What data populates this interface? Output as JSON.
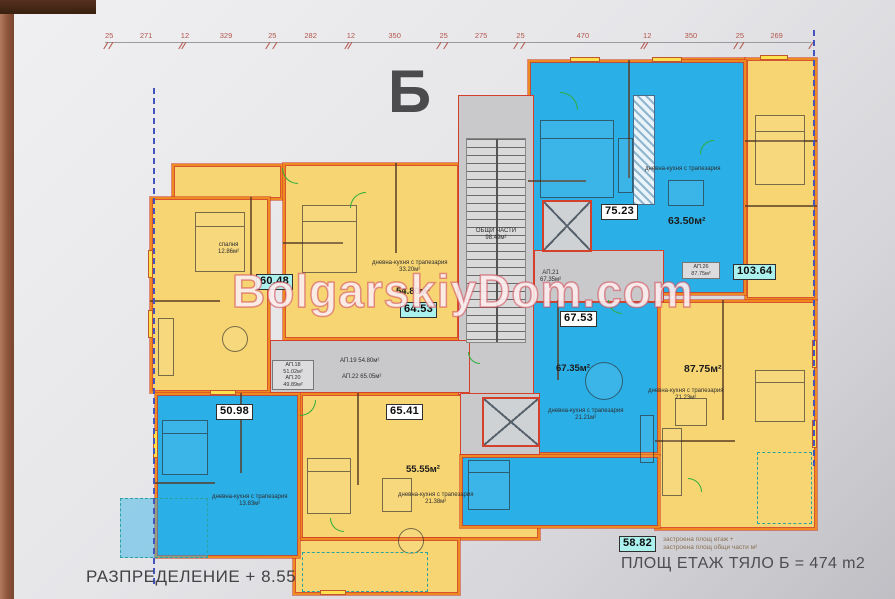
{
  "page": {
    "footer_title": "РАЗПРЕДЕЛЕНИЕ + 8.55",
    "total_area_text": "ПЛОЩ ЕТАЖ ТЯЛО Б = 474 m2",
    "block_letter": "Б"
  },
  "watermark": {
    "text": "BolgarskiyDom.com"
  },
  "legend": {
    "sample_value": "58.82",
    "line1": "застроена площ етаж +",
    "line2": "застроена площ общи части м²"
  },
  "dimensions": {
    "values": [
      25,
      271,
      12,
      329,
      25,
      282,
      12,
      350,
      25,
      275,
      25,
      470,
      12,
      350,
      25,
      269
    ]
  },
  "common": {
    "name": "ОБЩИ ЧАСТИ",
    "area": "98.49м²"
  },
  "labels": {
    "a6048": "60.48",
    "a6453": "64.53",
    "a7523": "75.23",
    "a10364": "103.64",
    "a6753": "67.53",
    "a5098": "50.98",
    "a6541": "65.41",
    "m5480": "54.80м²",
    "m6350": "63.50м²",
    "m6735": "67.35м²",
    "m8775": "87.75м²",
    "m5555": "55.55м²"
  },
  "rooms": {
    "bedroom_6048": {
      "name": "спалня",
      "area": "12.86м²"
    },
    "living_6453": {
      "name": "дневна-кухня с трапезария",
      "area": "33.20м²"
    },
    "living_7523": {
      "name": "дневна-кухня с трапезария"
    },
    "living_6735": {
      "name": "дневна-кухня с трапезария",
      "area": "21.21м²"
    },
    "living_5098": {
      "name": "дневна-кухня с трапезария",
      "area": "13.83м²"
    },
    "living_8775": {
      "name": "дневна-кухня с трапезария",
      "area": "21.23м²"
    },
    "living_5555": {
      "name": "дневна-кухня с трапезария",
      "area": "21.38м²"
    }
  },
  "corridor": {
    "ap19": "АП.19  54.80м²",
    "ap22": "АП.22  65.05м²",
    "ap21_name": "АП.21",
    "ap21_area": "67.35м²",
    "boxl_l1": "АП.18",
    "boxl_l2": "51.02м²",
    "boxl_l3": "АП.20",
    "boxl_l4": "49.89м²",
    "boxr_l1": "АП.26",
    "boxr_l2": "87.75м²"
  }
}
